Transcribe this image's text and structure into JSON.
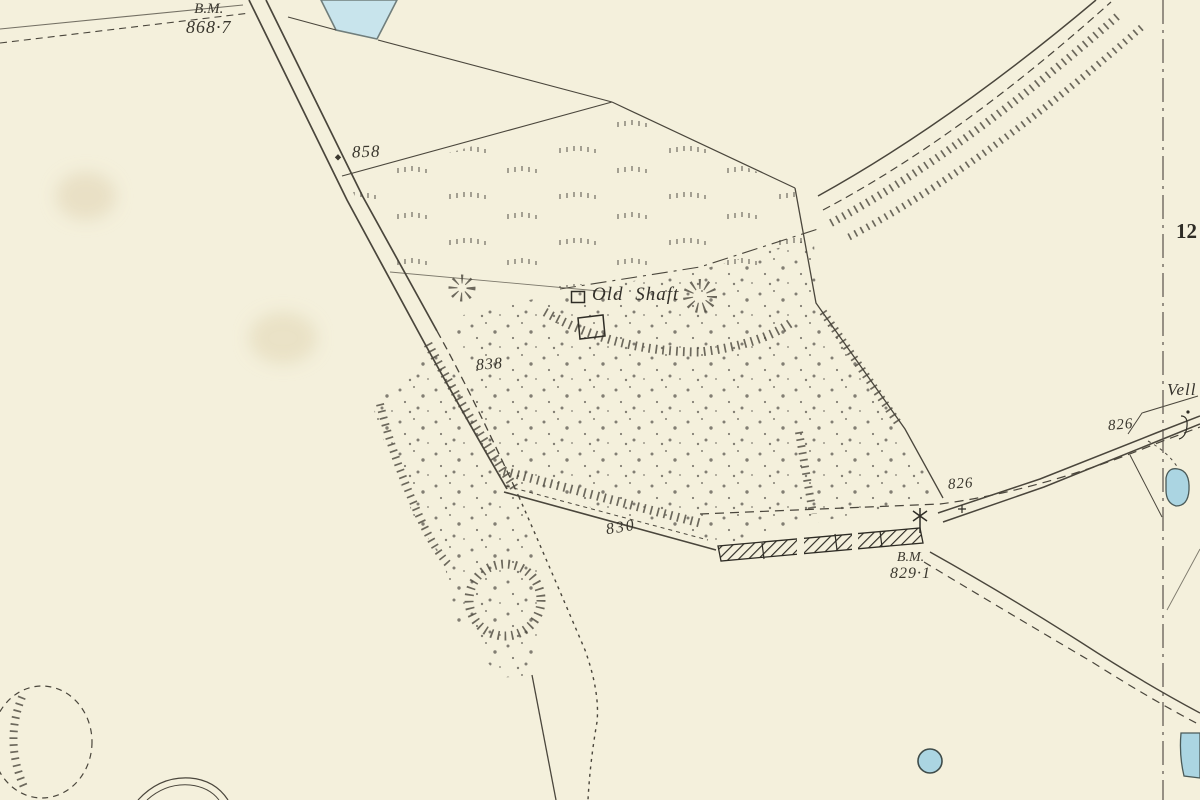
{
  "map": {
    "background_color": "#f4f0dc",
    "ink_color": "#4a463c",
    "water_color": "#abd5e2",
    "labels": {
      "bm_top_line1": "B.M.",
      "bm_top_line2": "868·7",
      "spot_858": "858",
      "old_shaft": "Old Shaft",
      "spot_838": "838",
      "spot_830": "830",
      "spot_826_west": "826",
      "spot_826_east": "826",
      "bm_829_line1": "B.M.",
      "bm_829_line2": "829·1",
      "well_fragment": "Vell",
      "sheet_number_fragment": "12"
    },
    "symbols": {
      "old_shaft_square": "square-outline-marker",
      "benchmark_cross": "cross-marker",
      "guide_post": "star-post-marker",
      "road_stone": "diamond-marker",
      "walled_bar": "hatched-wall-strip",
      "sheet_edge": "dash-dot-sheet-line"
    }
  }
}
